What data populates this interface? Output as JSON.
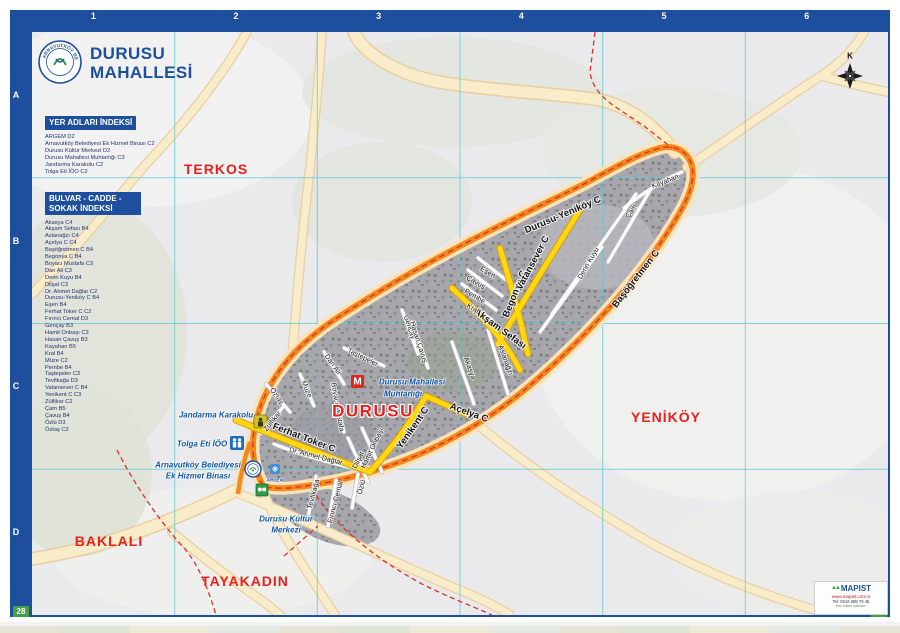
{
  "page": {
    "title_line1": "DURUSU",
    "title_line2": "MAHALLESİ"
  },
  "logo": {
    "text": "ARNAVUTKÖY BELEDİYESİ"
  },
  "grid": {
    "top": [
      "1",
      "2",
      "3",
      "4",
      "5",
      "6"
    ],
    "bottom": [
      "1",
      "2",
      "3",
      "4",
      "5",
      "6"
    ],
    "left": [
      "A",
      "B",
      "C",
      "D"
    ],
    "right": [
      "A",
      "B",
      "C",
      "D"
    ],
    "corner_bl": "28",
    "corner_br": "29"
  },
  "indexes": {
    "places": {
      "title": "YER ADLARI İNDEKSİ",
      "items": [
        "ARGEM D2",
        "Arnavutköy Belediyesi Ek Hizmet Binası C2",
        "Durusu Kültür Merkezi D2",
        "Durusu Mahallesi Muhtarlığı C3",
        "Jandarma Karakolu C2",
        "Tolga Eti İÖO C2"
      ]
    },
    "streets": {
      "title": "BULVAR - CADDE - SOKAK İNDEKSİ",
      "items": [
        "Akasya C4",
        "Akşam Sefası B4",
        "Aslanağzı C4",
        "Açelya C C4",
        "Başöğretmen C B4",
        "Begonya C B4",
        "Boyacı Mustafa C3",
        "Dan Ali C3",
        "Derin Kuyu B4",
        "Dilşat C3",
        "Dr. Ahmet Dağlar C2",
        "Durusu-Yeniköy C B4",
        "Eşen B4",
        "Ferhat Toker C C2",
        "Fırıncı Cemal D3",
        "Gençay B3",
        "Hamit Onbaşı C3",
        "Hasan Çavuş B3",
        "Kayahan B5",
        "Kral B4",
        "Müze C2",
        "Pembe B4",
        "Taştepeler C3",
        "Tevfikağa D3",
        "Vatansever C B4",
        "Yenikent C C3",
        "Zülfikar C2",
        "Çam B5",
        "Çavuş B4",
        "Özlü D3",
        "Öztaş C2"
      ]
    }
  },
  "map": {
    "compass_letter": "K",
    "muhtarlik_letter": "M",
    "area_labels": [
      {
        "text": "TERKOS",
        "x": 184,
        "y": 137
      },
      {
        "text": "YENİKÖY",
        "x": 634,
        "y": 385
      },
      {
        "text": "BAKLALI",
        "x": 77,
        "y": 509
      },
      {
        "text": "TAYAKADIN",
        "x": 213,
        "y": 549
      },
      {
        "text": "DURUSU",
        "x": 341,
        "y": 379,
        "cls": "big"
      }
    ],
    "street_labels": [
      {
        "text": "Ferhat Toker C",
        "x": 272,
        "y": 406,
        "r": 21,
        "cls": "major"
      },
      {
        "text": "Yenikent C",
        "x": 381,
        "y": 396,
        "r": -55,
        "cls": "major"
      },
      {
        "text": "Akşam Sefası",
        "x": 468,
        "y": 297,
        "r": 36,
        "cls": "major"
      },
      {
        "text": "Begonya C",
        "x": 483,
        "y": 262,
        "r": -68,
        "cls": "major"
      },
      {
        "text": "Vatansever C",
        "x": 501,
        "y": 231,
        "r": -62,
        "cls": "major"
      },
      {
        "text": "Durusu-Yeniköy C",
        "x": 531,
        "y": 183,
        "r": -23,
        "cls": "major"
      },
      {
        "text": "Başöğretmen C",
        "x": 604,
        "y": 247,
        "r": -52,
        "cls": "major"
      },
      {
        "text": "Açelya C",
        "x": 437,
        "y": 381,
        "r": 20,
        "cls": "major"
      },
      {
        "text": "Kayahan",
        "x": 633,
        "y": 149,
        "r": -21
      },
      {
        "text": "Çam",
        "x": 599,
        "y": 179,
        "r": -56
      },
      {
        "text": "Derin Kuyu",
        "x": 556,
        "y": 231,
        "r": -60
      },
      {
        "text": "Eşen",
        "x": 456,
        "y": 240,
        "r": 30
      },
      {
        "text": "Çavuş",
        "x": 444,
        "y": 250,
        "r": 30
      },
      {
        "text": "Pembe",
        "x": 443,
        "y": 264,
        "r": 30
      },
      {
        "text": "Kral",
        "x": 441,
        "y": 276,
        "r": 30
      },
      {
        "text": "Aslanağzı",
        "x": 474,
        "y": 328,
        "r": 70
      },
      {
        "text": "Akasya",
        "x": 438,
        "y": 336,
        "r": 70
      },
      {
        "text": "Gençay",
        "x": 378,
        "y": 295,
        "r": 72
      },
      {
        "text": "Hasan Çavuş",
        "x": 387,
        "y": 310,
        "r": 72
      },
      {
        "text": "Taştepeler",
        "x": 331,
        "y": 325,
        "r": 26
      },
      {
        "text": "Dan Ali",
        "x": 301,
        "y": 332,
        "r": 55
      },
      {
        "text": "Müze",
        "x": 275,
        "y": 357,
        "r": 68
      },
      {
        "text": "Öztaş",
        "x": 245,
        "y": 364,
        "r": 55
      },
      {
        "text": "Boyacı Mustafa",
        "x": 306,
        "y": 375,
        "r": 80
      },
      {
        "text": "Zülfikar",
        "x": 240,
        "y": 389,
        "r": -52
      },
      {
        "text": "Dr. Ahmet Dağlar",
        "x": 284,
        "y": 424,
        "r": 14
      },
      {
        "text": "Hamit Onbaşı",
        "x": 340,
        "y": 416,
        "r": -64
      },
      {
        "text": "Dilşat",
        "x": 326,
        "y": 428,
        "r": -64
      },
      {
        "text": "Tevfikağa",
        "x": 281,
        "y": 462,
        "r": -75
      },
      {
        "text": "Fırıncı Cemal",
        "x": 303,
        "y": 470,
        "r": -75
      },
      {
        "text": "Özlü",
        "x": 329,
        "y": 455,
        "r": -75
      }
    ],
    "poi_labels": [
      {
        "text": "Jandarma Karakolu",
        "x": 184,
        "y": 383
      },
      {
        "text": "Tolga Eti İÖO",
        "x": 170,
        "y": 412
      },
      {
        "text": "Arnavutköy Belediyesi",
        "x": 166,
        "y": 433
      },
      {
        "text": "Ek Hizmet Binası",
        "x": 166,
        "y": 444
      },
      {
        "text": "Durusu Kültür",
        "x": 254,
        "y": 487
      },
      {
        "text": "Merkezi",
        "x": 254,
        "y": 498
      },
      {
        "text": "Durusu Mahallesi",
        "x": 380,
        "y": 350
      },
      {
        "text": "Muhtarlığı",
        "x": 371,
        "y": 362
      },
      {
        "text": "ARGEM",
        "x": 243,
        "y": 448,
        "cls": "tiny"
      }
    ]
  },
  "publisher": {
    "name": "MAPIST",
    "website": "www.mapist.com.tr",
    "phone": "Tel: 0216 688 79 45",
    "note": "Her hakkı saklıdır."
  },
  "colors": {
    "frame_blue": "#1e4f9e",
    "ring_orange": "#f2891c",
    "road_yellow": "#ffd70f",
    "boundary_red": "#e03024",
    "grid_cyan": "#62cbd3",
    "corner_green": "#43a047",
    "area_label_red": "#e8201d",
    "poi_blue": "#1356a8"
  }
}
